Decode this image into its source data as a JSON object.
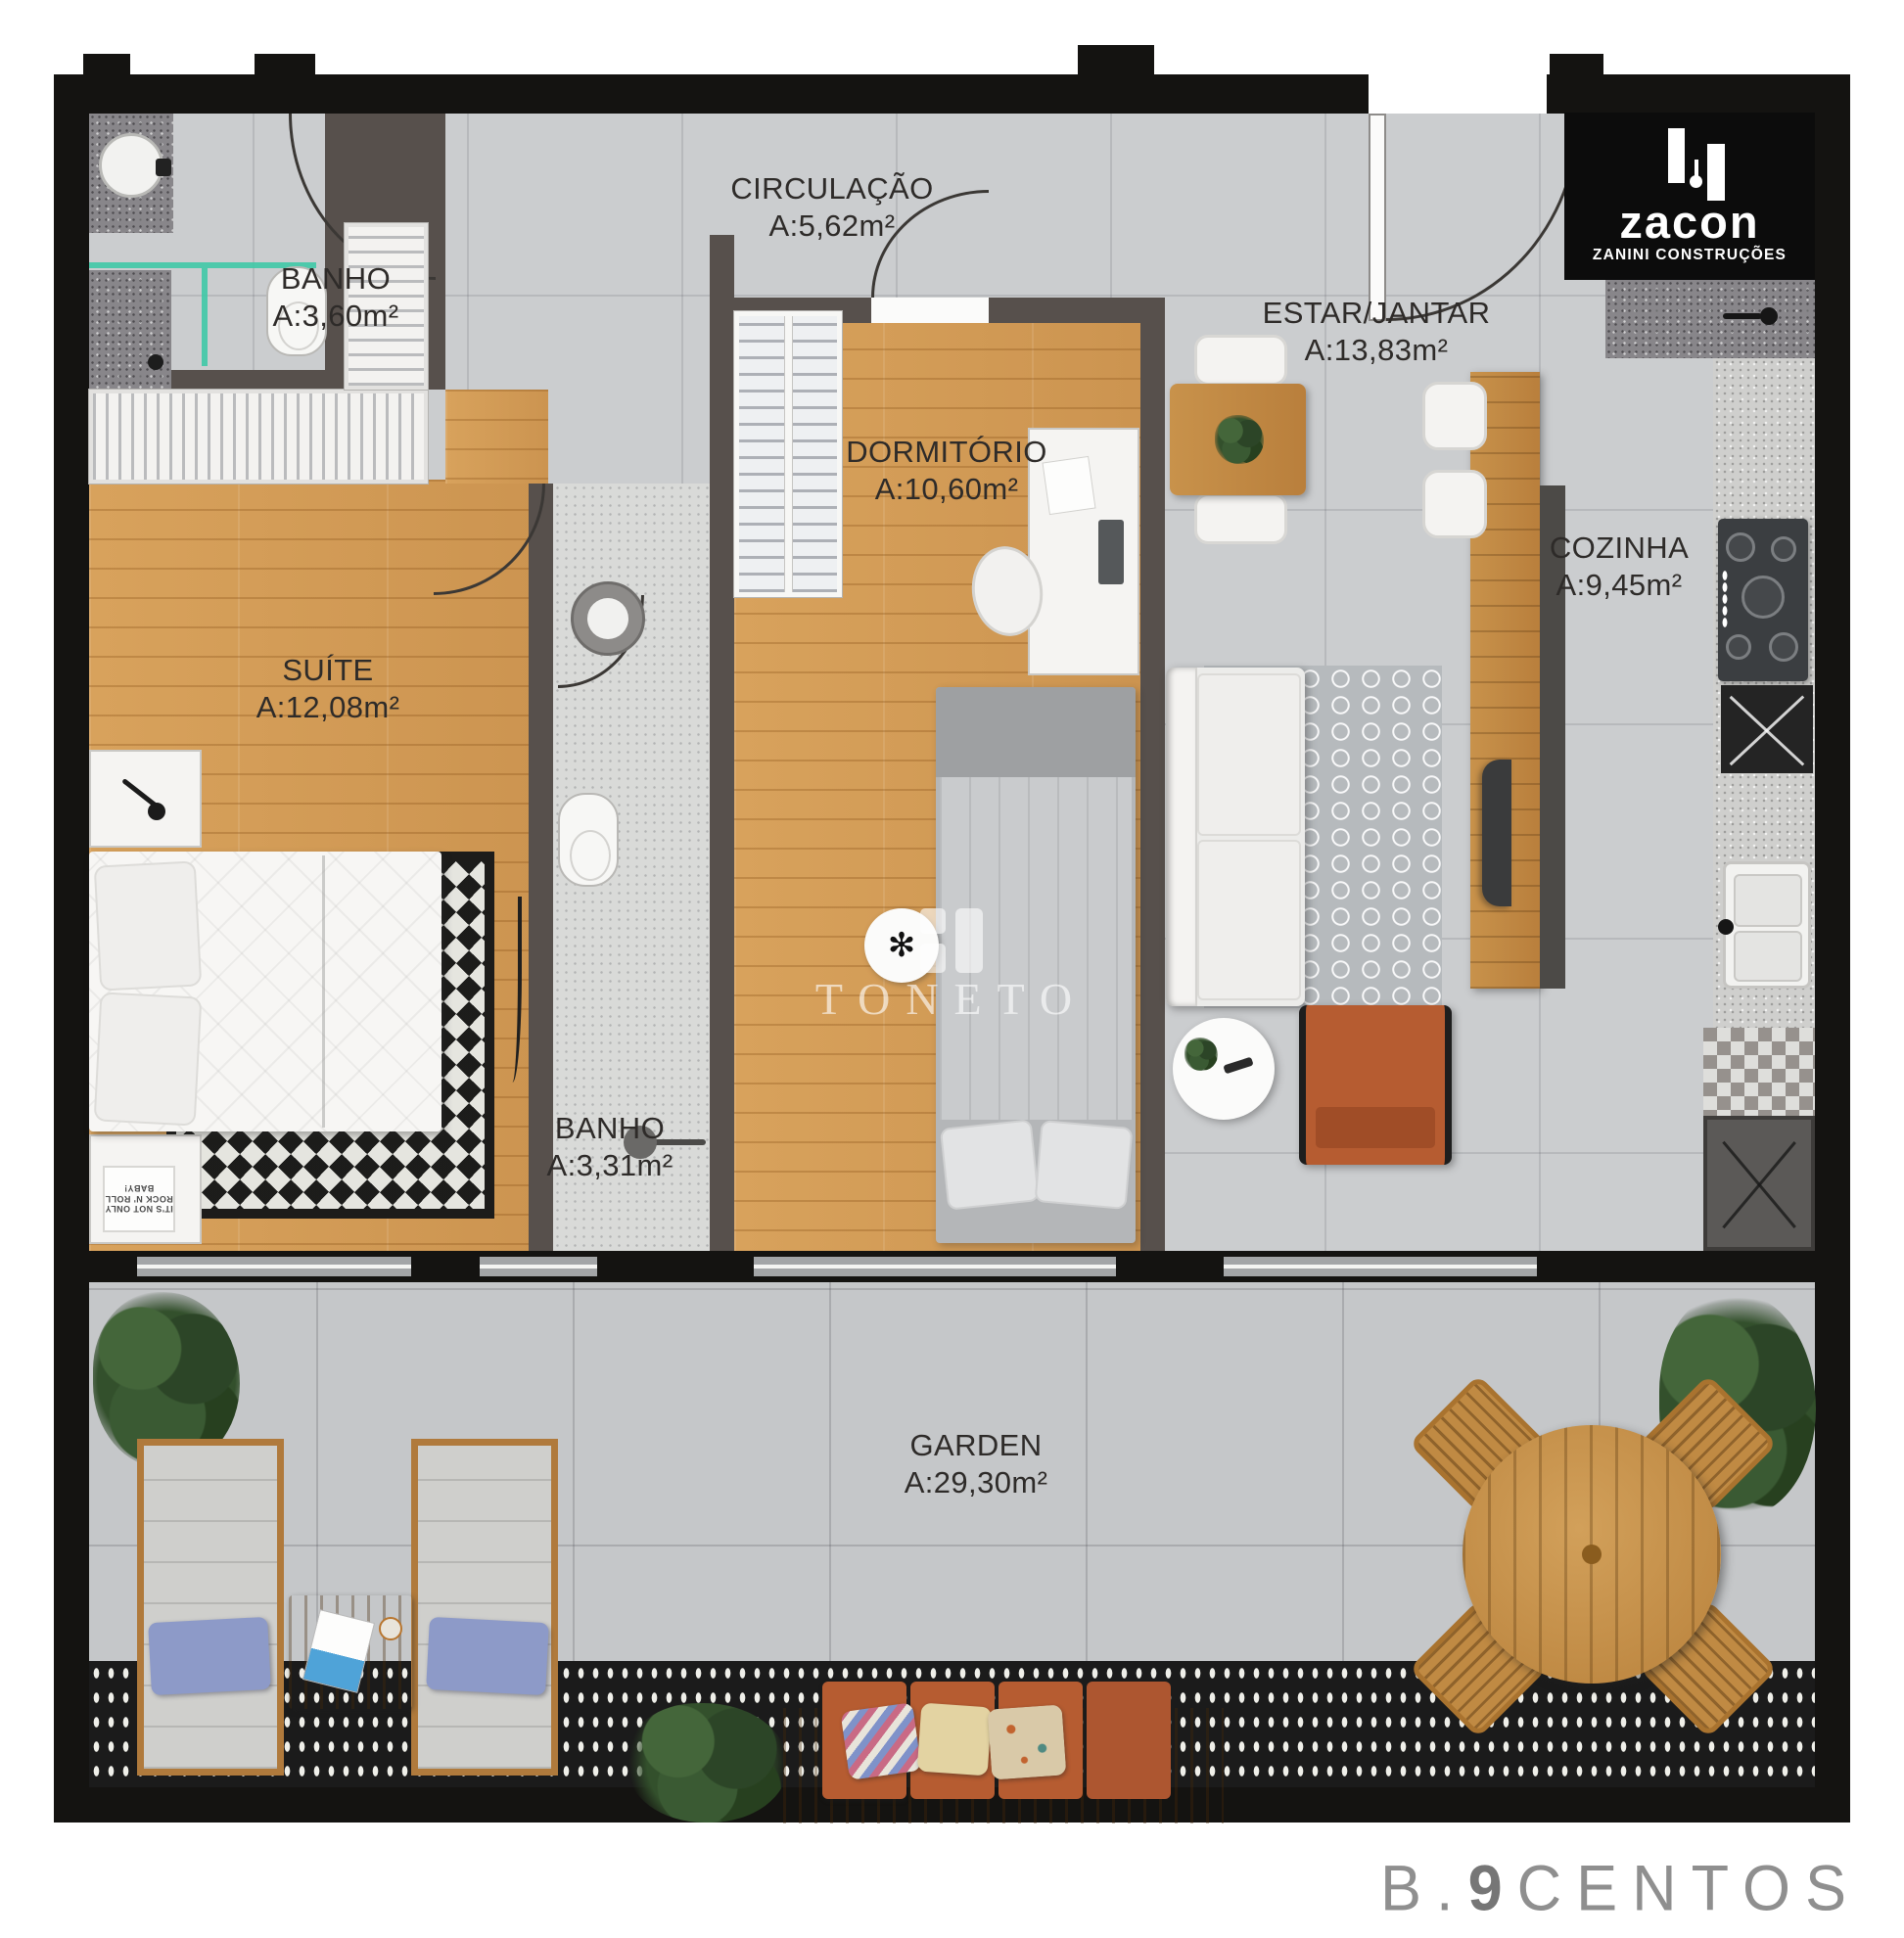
{
  "branding": {
    "builder_logo": "zacon",
    "builder_tagline": "ZANINI CONSTRUÇÕES",
    "watermark": "TONETO",
    "project_prefix": "B.",
    "project_number": "9",
    "project_suffix": "CENTOS"
  },
  "rooms": [
    {
      "name": "CIRCULAÇÃO",
      "area": "A:5,62m²"
    },
    {
      "name": "BANHO",
      "area": "A:3,60m²"
    },
    {
      "name": "ESTAR/JANTAR",
      "area": "A:13,83m²"
    },
    {
      "name": "DORMITÓRIO",
      "area": "A:10,60m²"
    },
    {
      "name": "COZINHA",
      "area": "A:9,45m²"
    },
    {
      "name": "SUÍTE",
      "area": "A:12,08m²"
    },
    {
      "name": "BANHO",
      "area": "A:3,31m²"
    },
    {
      "name": "GARDEN",
      "area": "A:29,30m²"
    }
  ],
  "suite_poster": "IT'S NOT ONLY ROCK N' ROLL BABY!",
  "colors": {
    "outer_wall": "#141311",
    "inner_wall": "#57504c",
    "floor_tile": "#cbcdcf",
    "garden_tile": "#c5c7c9",
    "wood_floor": "#d49d57",
    "label_text": "#2e2b29",
    "shower_glass": "#3fc9a6",
    "armchair_orange": "#b65c31",
    "pillow_blue": "#8d9ac8",
    "logo_bg": "#0c0c0c",
    "project_gray": "#8f8f8f"
  }
}
